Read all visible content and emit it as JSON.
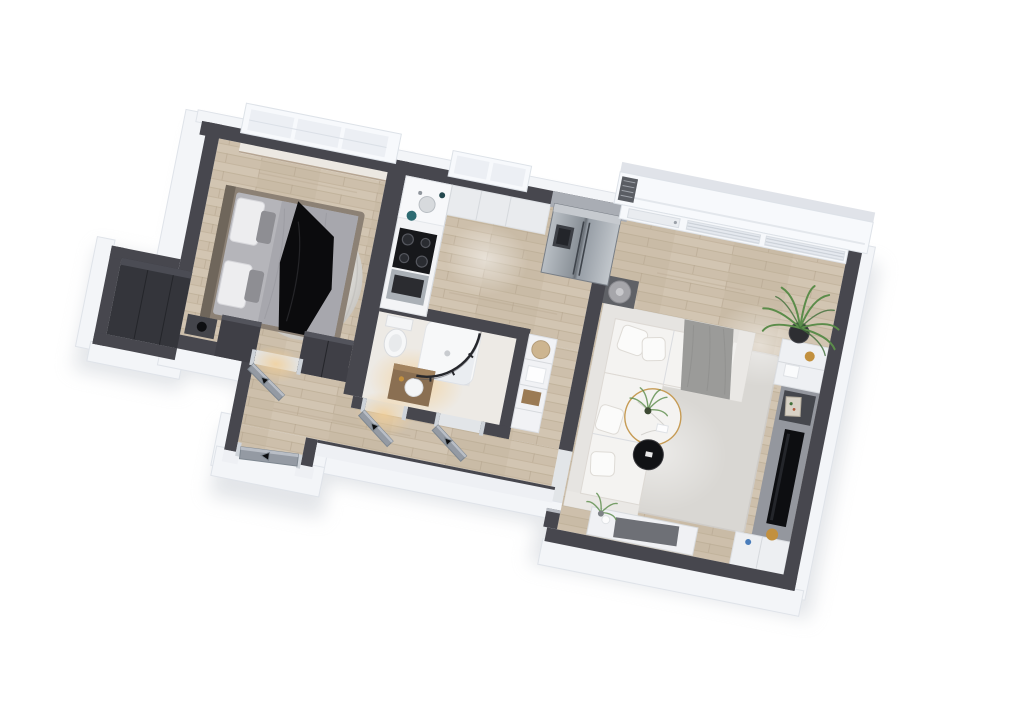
{
  "scene": {
    "kind": "3d-apartment-floorplan-render",
    "background": "#ffffff",
    "rotation_deg": 11.3,
    "rooms": [
      {
        "id": "bedroom",
        "label": "Bedroom",
        "furniture": [
          "double bed",
          "white pillows",
          "black throw blanket",
          "fluffy area rug",
          "nightstand with lamp",
          "wall-mounted tv",
          "dark wardrobe",
          "closet niche",
          "triple window",
          "window sill bench"
        ]
      },
      {
        "id": "kitchen",
        "label": "Kitchen",
        "furniture": [
          "l-shaped white counter",
          "black cooktop",
          "built-in oven",
          "round sink",
          "teal kettle",
          "upper cabinets",
          "stainless fridge freezer",
          "double window"
        ]
      },
      {
        "id": "bathroom",
        "label": "Bathroom",
        "furniture": [
          "toilet",
          "curved glass shower",
          "wood vanity with basin",
          "gold fixtures",
          "storage shelving with basket"
        ]
      },
      {
        "id": "hallway",
        "label": "Hallway",
        "furniture": [
          "bedroom door",
          "bathroom door",
          "storage door",
          "entry door",
          "door swing arrows"
        ]
      },
      {
        "id": "living_room",
        "label": "Living room",
        "furniture": [
          "white sectional sofa",
          "gray throw blanket",
          "area rug",
          "round marble coffee table with plant",
          "black side table",
          "lamp side table",
          "media wall unit with tv panel",
          "leaning art frame",
          "gold decor",
          "sideboard console with plant",
          "potted palm",
          "balcony glazing with blinds",
          "balcony door",
          "vent grille"
        ]
      }
    ],
    "palette": {
      "wall": "#47474e",
      "wall_cap": "#6a6a72",
      "shell": "#f3f5f8",
      "shadow": "#c7ccd3",
      "wood": "#cdbfab",
      "wood_gap": "#b7a78f",
      "wood_light": "#d8ccba",
      "tile": "#edeae5",
      "rug": "#d9d7d3",
      "rug_fluffy": "#e6e5e2",
      "sofa": "#f1f0ee",
      "sofa_throw": "#9b9b99",
      "bed_frame": "#8c8175",
      "mattress": "#b5b5ba",
      "duvet": "#a7a7ad",
      "pillow": "#ededef",
      "bed_throw": "#0b0b0d",
      "door": "#949aa3",
      "door_frame": "#ced3d9",
      "steel": "#8a9198",
      "counter": "#f3f4f6",
      "cabinet": "#e9ebee",
      "cooktop": "#17181b",
      "window_frame": "#f7f9fc",
      "glass": "#e5e9ef",
      "blinds": "#c7cdd5",
      "plant": "#5b8c4a",
      "plant_dark": "#41703a",
      "pot": "#2d2e32",
      "gold": "#c2903e",
      "black": "#111215",
      "marble": "#f4f3f1",
      "teal": "#2e6b72",
      "warm_light": "#f3cf96",
      "fridge_panel": "#a9adb4",
      "media_panel": "#94979e",
      "vanity_wood": "#8a6f52",
      "basket": "#cdb590"
    }
  }
}
